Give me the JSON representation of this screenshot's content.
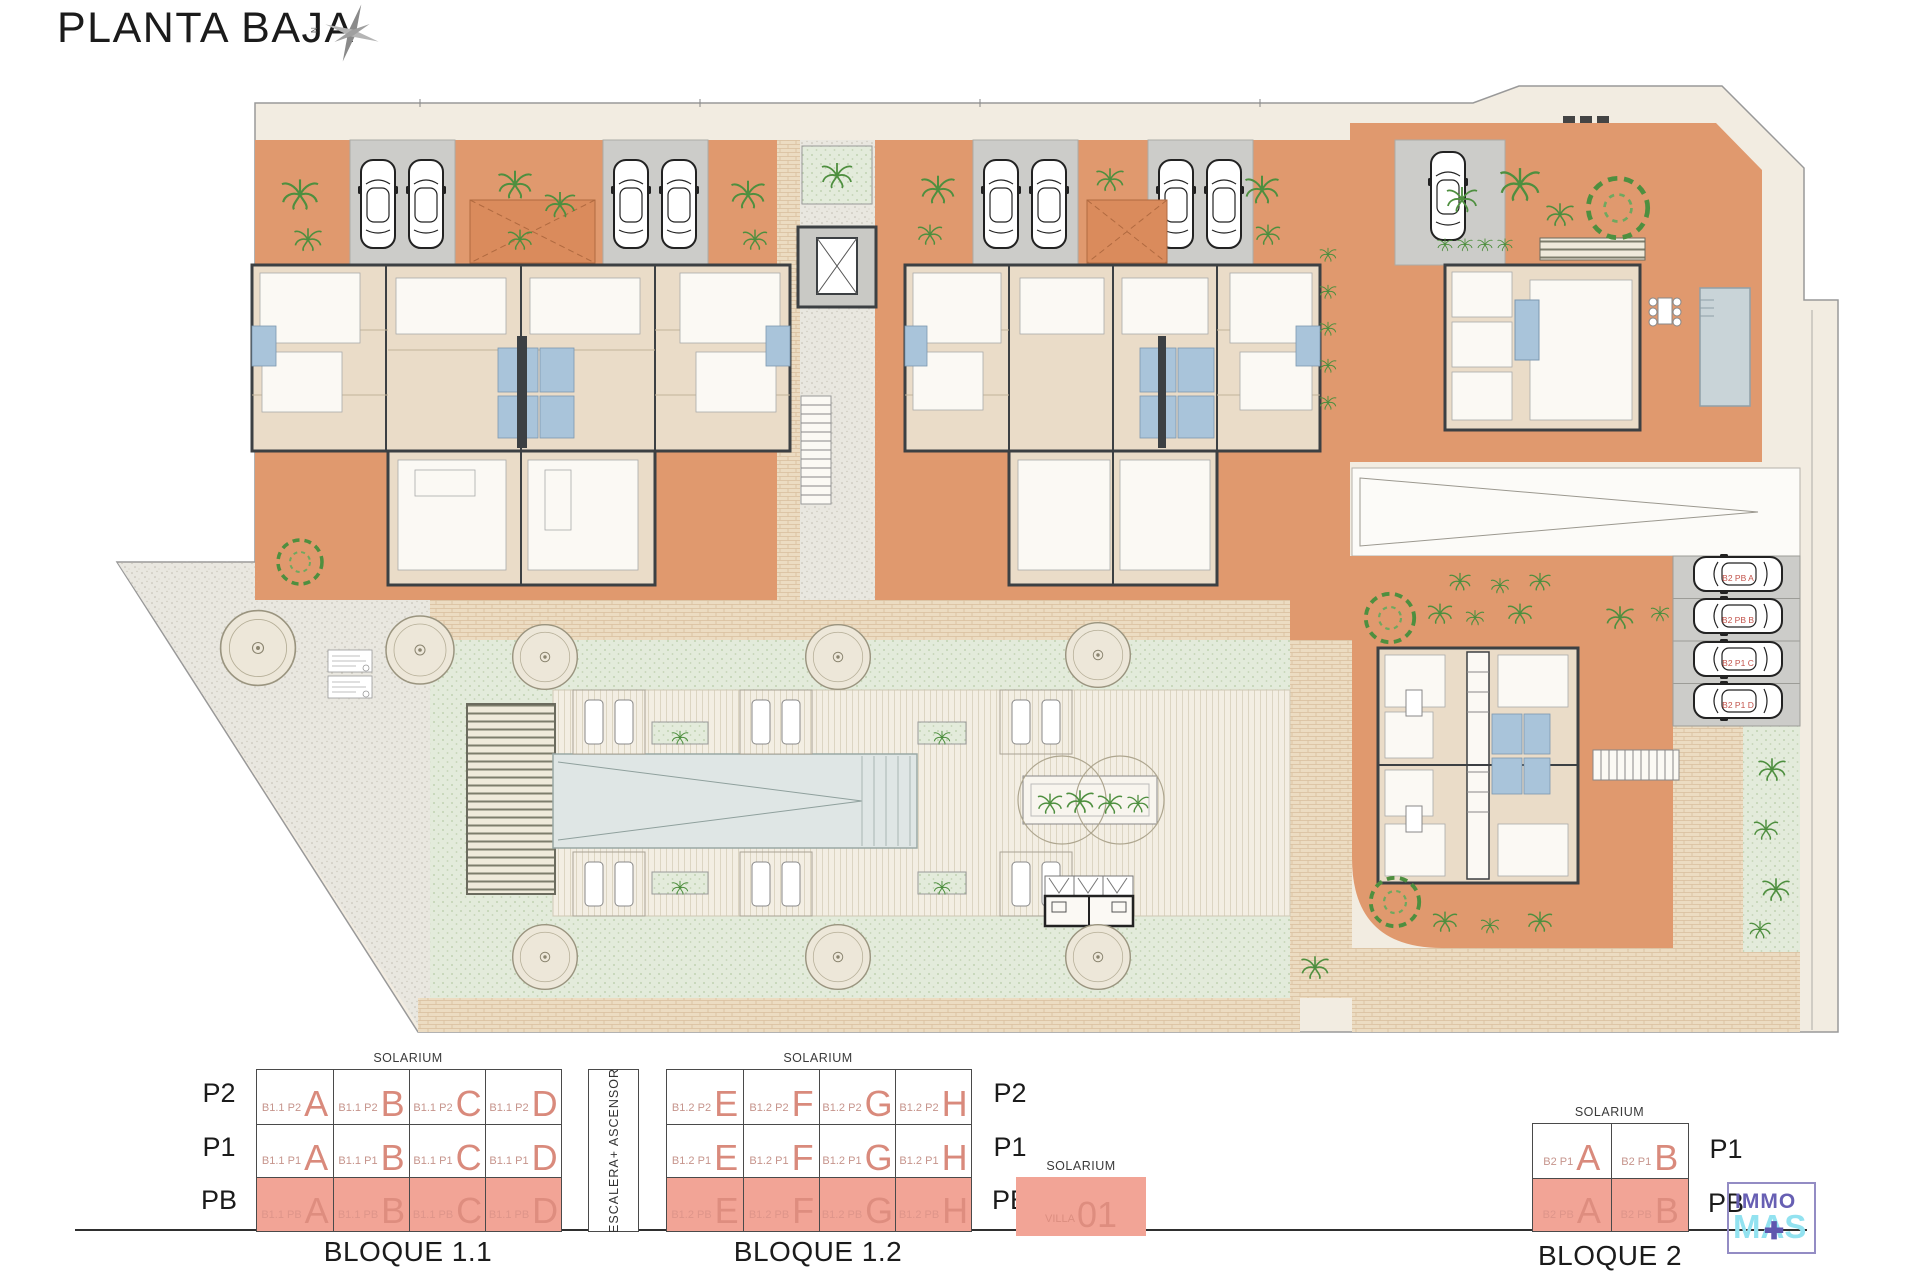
{
  "header": {
    "title": "PLANTA BAJA",
    "compass_n": "N"
  },
  "labels": {
    "solarium": "SOLARIUM",
    "stairs": "ESCALERA+ ASCENSOR"
  },
  "site_plan": {
    "parking_labels": [
      "B2 PB A",
      "B2 PB B",
      "B2 P1 C",
      "B2 P1 D"
    ]
  },
  "bloque_1_1": {
    "caption": "BLOQUE 1.1",
    "floors": [
      "P2",
      "P1",
      "PB"
    ],
    "cells": [
      [
        [
          "B1.1 P2",
          "A"
        ],
        [
          "B1.1 P2",
          "B"
        ],
        [
          "B1.1 P2",
          "C"
        ],
        [
          "B1.1 P2",
          "D"
        ]
      ],
      [
        [
          "B1.1 P1",
          "A"
        ],
        [
          "B1.1 P1",
          "B"
        ],
        [
          "B1.1 P1",
          "C"
        ],
        [
          "B1.1 P1",
          "D"
        ]
      ],
      [
        [
          "B1.1 PB",
          "A"
        ],
        [
          "B1.1 PB",
          "B"
        ],
        [
          "B1.1 PB",
          "C"
        ],
        [
          "B1.1 PB",
          "D"
        ]
      ]
    ]
  },
  "bloque_1_2": {
    "caption": "BLOQUE 1.2",
    "floors": [
      "P2",
      "P1",
      "PB"
    ],
    "cells": [
      [
        [
          "B1.2 P2",
          "E"
        ],
        [
          "B1.2 P2",
          "F"
        ],
        [
          "B1.2 P2",
          "G"
        ],
        [
          "B1.2 P2",
          "H"
        ]
      ],
      [
        [
          "B1.2 P1",
          "E"
        ],
        [
          "B1.2 P1",
          "F"
        ],
        [
          "B1.2 P1",
          "G"
        ],
        [
          "B1.2 P1",
          "H"
        ]
      ],
      [
        [
          "B1.2 PB",
          "E"
        ],
        [
          "B1.2 PB",
          "F"
        ],
        [
          "B1.2 PB",
          "G"
        ],
        [
          "B1.2 PB",
          "H"
        ]
      ]
    ]
  },
  "villa": {
    "name_small": "VILLA",
    "name_big": "01"
  },
  "bloque_2": {
    "caption": "BLOQUE 2",
    "floors": [
      "P1",
      "PB"
    ],
    "cells": [
      [
        [
          "B2 P1",
          "A"
        ],
        [
          "B2 P1",
          "B"
        ]
      ],
      [
        [
          "B2 PB",
          "A"
        ],
        [
          "B2 PB",
          "B"
        ]
      ]
    ]
  },
  "logo": {
    "word1": "IMMO",
    "word2": "MAS",
    "plus": "✚"
  },
  "colors": {
    "terrace_orange": "#E0996E",
    "highlight_salmon": "#F2A496",
    "unit_letter_salmon": "#D98A7C",
    "logo_purple": "#675FB3",
    "logo_cyan": "#92E2F0",
    "parking_label_red": "#C2534B"
  }
}
